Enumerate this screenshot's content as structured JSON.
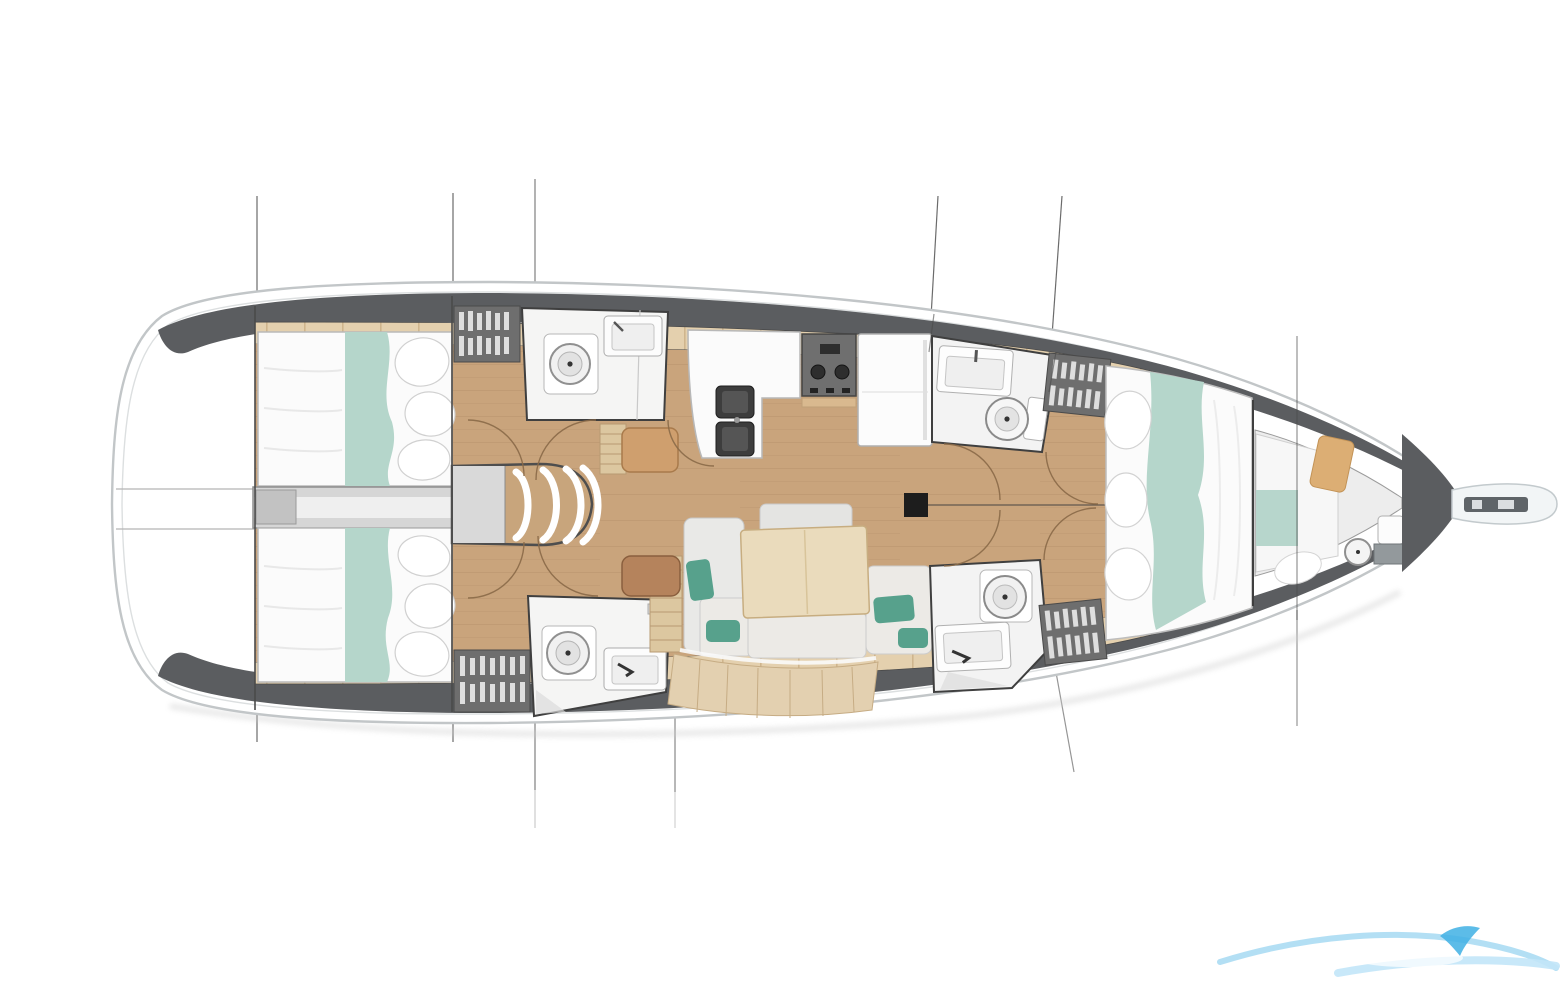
{
  "page": {
    "title": "Sailboat interior layout floor plan, top view, bow pointing right",
    "background": "#ffffff"
  },
  "colors": {
    "hull_fill": "#ffffff",
    "hull_stroke": "#c2c6c8",
    "hull_inner_stroke": "#dcdfe0",
    "deck_dark": "#5b5d60",
    "deck_plank": "#e4d0ae",
    "plank_seam": "#c9ae85",
    "floor_wood": "#c9a47c",
    "room_white": "#f5f5f4",
    "wall_dark": "#3f3f3f",
    "bed_white": "#fbfbfb",
    "teal_runner": "#b5d6cb",
    "teal_accent": "#57a18c",
    "wardrobe_dark": "#6e6e6e",
    "steps_gray": "#d9d9d9",
    "stove_dark": "#6f6f6f",
    "sink_dark": "#3d3d3d",
    "table_wood": "#eadbbc",
    "side_table_brown": "#b5835c",
    "cabinet_tan": "#cf9f6e",
    "mast_black": "#1d1d1d",
    "rig_line": "#6b6b6b",
    "door_arc": "#8a6a48",
    "logo_light": "#a6d9f2",
    "logo_pale": "#c2e6f8",
    "logo_dark": "#3fb0e4"
  },
  "boat": {
    "orientation": "bow-right",
    "regions": [
      "transom-platform",
      "aft-cabin-port",
      "aft-cabin-starboard",
      "engine-compartment",
      "companionway-steps",
      "aft-head-port",
      "aft-head-starboard",
      "galley",
      "refrigerator",
      "saloon-dinette",
      "forward-head-port",
      "forward-head-starboard",
      "forward-cabin-v-berth",
      "forepeak-crew-cabin",
      "anchor-locker",
      "bow-anchor-platform"
    ],
    "berths": [
      "aft-double-port",
      "aft-double-starboard",
      "forward-v-berth",
      "forepeak-berth"
    ],
    "heads_count": 4,
    "toilets_count": 5,
    "wardrobes_count": 4,
    "mast_position": {
      "x": 916,
      "y": 505
    },
    "section_lines_x": [
      257,
      453,
      535,
      675,
      938,
      1058,
      1297
    ],
    "centerline_y": 505,
    "watermark": {
      "name": "wave-logo",
      "corner": "bottom-right"
    }
  }
}
